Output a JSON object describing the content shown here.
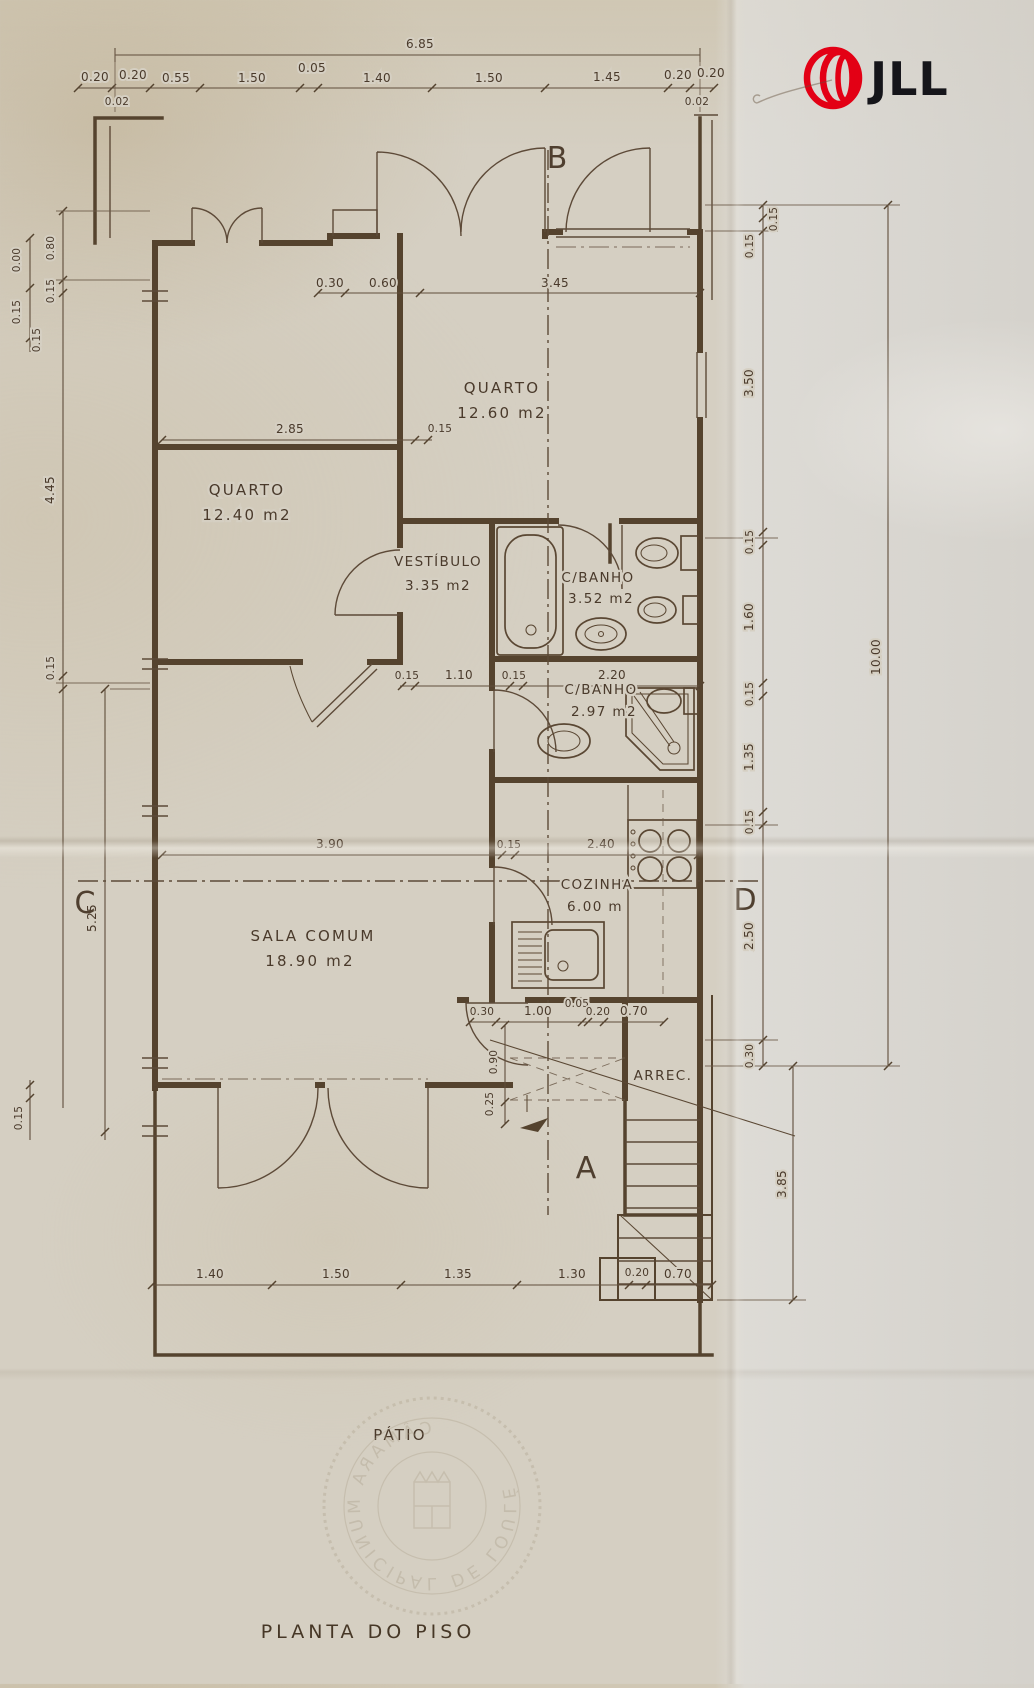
{
  "brand": {
    "name": "JLL"
  },
  "title": "PLANTA DO PISO",
  "stamp": "CÂMARA MUNICIPAL DE LOULÉ",
  "colors": {
    "paper": "#d5cfc2",
    "ink": "#55432e",
    "dim_text": "#4a3a2b",
    "logo_red": "#e30015",
    "logo_black": "#15151a"
  },
  "rooms": {
    "quarto1": {
      "name": "QUARTO",
      "area": "12.60 m2"
    },
    "quarto2": {
      "name": "QUARTO",
      "area": "12.40 m2"
    },
    "vestibulo": {
      "name": "VESTÍBULO",
      "area": "3.35 m2"
    },
    "banho1": {
      "name": "C/BANHO",
      "area": "3.52 m2"
    },
    "banho2": {
      "name": "C/BANHO",
      "area": "2.97 m2"
    },
    "sala": {
      "name": "SALA COMUM",
      "area": "18.90 m2"
    },
    "cozinha": {
      "name": "COZINHA",
      "area": "6.00 m"
    },
    "arrec": {
      "name": "ARREC."
    },
    "patio": {
      "name": "PÁTIO"
    }
  },
  "sections": {
    "a": "A",
    "b": "B",
    "c": "C",
    "d": "D"
  },
  "dims": {
    "top_total": "6.85",
    "top": [
      "0.20",
      "0.20",
      "0.55",
      "1.50",
      "0.05",
      "1.40",
      "1.50",
      "1.45",
      "0.20",
      "0.20"
    ],
    "top_small": [
      "0.02",
      "0.02"
    ],
    "upper_inner": [
      "0.30",
      "0.60",
      "3.45"
    ],
    "quarto2_top": [
      "2.85",
      "0.15"
    ],
    "hall": [
      "0.15",
      "1.10",
      "0.15",
      "2.20"
    ],
    "sala_line": [
      "3.90",
      "0.15",
      "2.40"
    ],
    "back": [
      "0.30",
      "1.00",
      "0.05",
      "0.20",
      "0.70"
    ],
    "back_vert": [
      "0.90",
      "0.25"
    ],
    "bottom": [
      "1.40",
      "1.50",
      "1.35",
      "1.30",
      "0.20",
      "0.70"
    ],
    "right": [
      "0.15",
      "0.15",
      "3.50",
      "0.15",
      "1.60",
      "0.15",
      "1.35",
      "0.15",
      "2.50",
      "0.30"
    ],
    "right_total": "10.00",
    "right_lower": "3.85",
    "left": [
      "0.00",
      "0.15",
      "0.15",
      "0.80",
      "0.15",
      "4.45",
      "0.15",
      "5.25",
      "0.15"
    ]
  }
}
